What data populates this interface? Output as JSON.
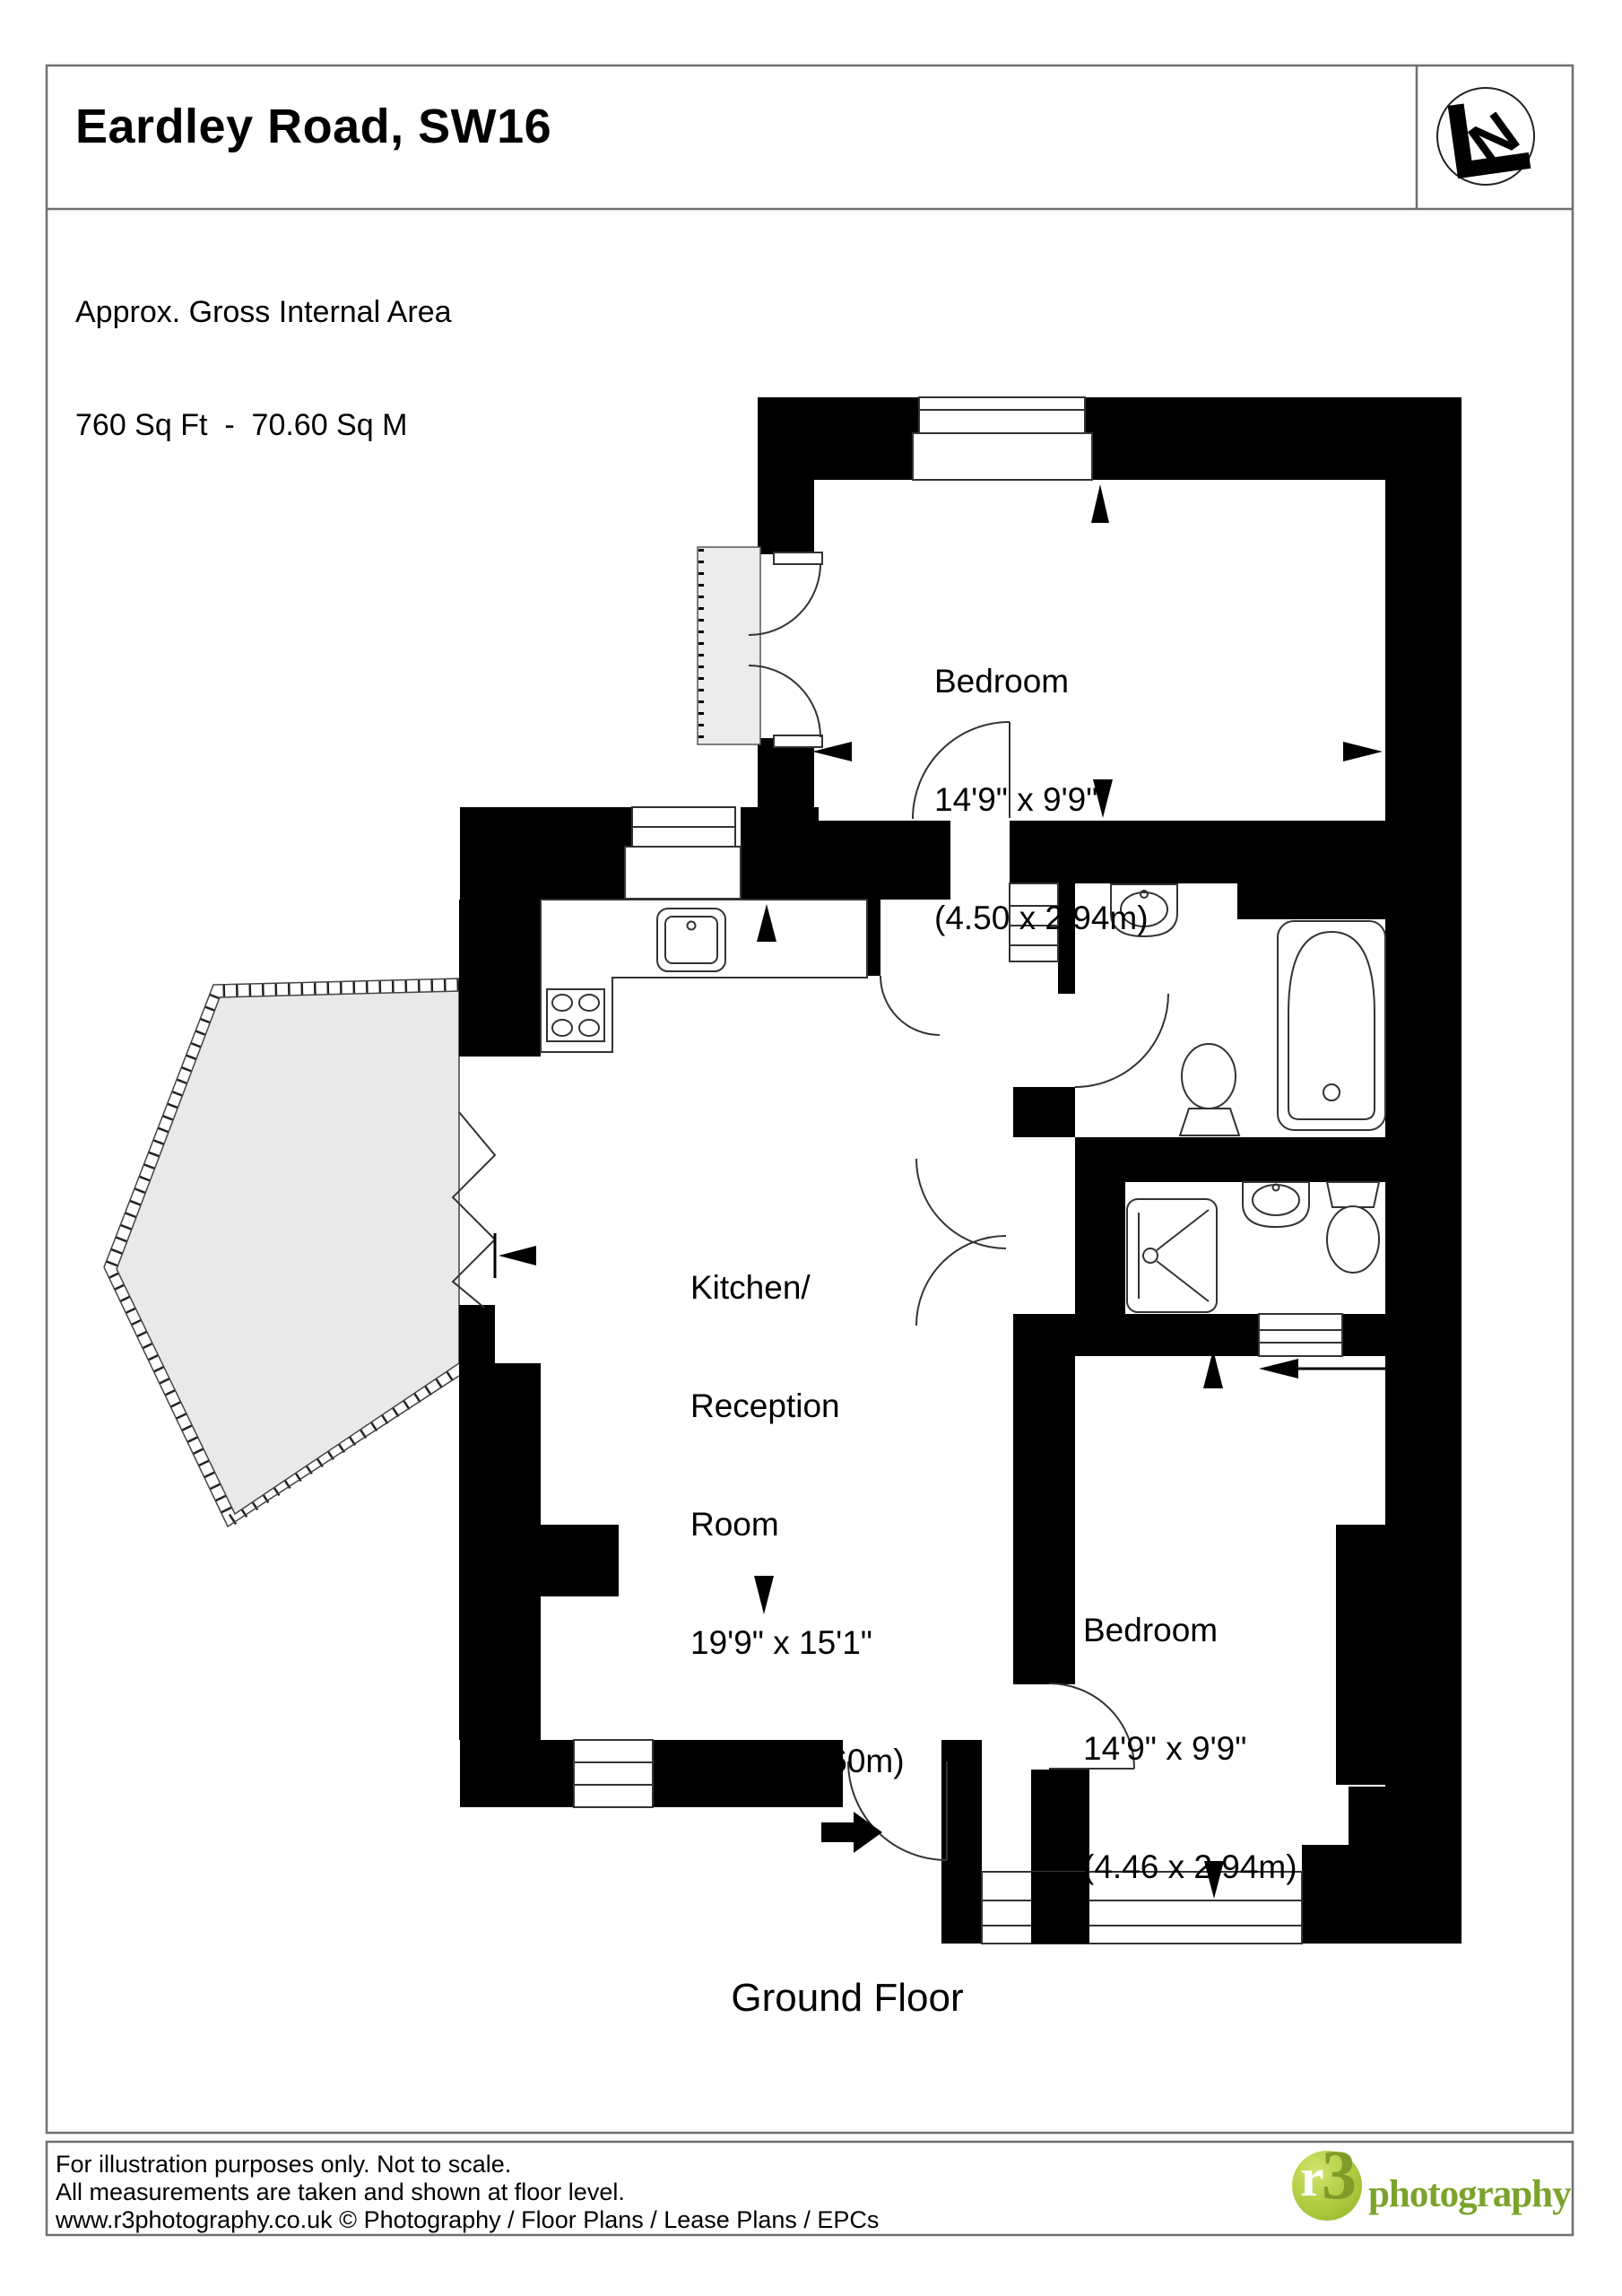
{
  "page": {
    "title": "Eardley Road, SW16",
    "area_line1": "Approx. Gross Internal Area",
    "area_line2": "760 Sq Ft  -  70.60 Sq M",
    "floor_label": "Ground Floor"
  },
  "logo": {
    "compass_letter": "N"
  },
  "rooms": {
    "bedroom_top": {
      "name": "Bedroom",
      "imperial": "14'9\" x 9'9\"",
      "metric": "(4.50 x 2.94m)"
    },
    "kitchen": {
      "line1": "Kitchen/",
      "line2": "Reception",
      "line3": "Room",
      "imperial": "19'9\" x 15'1\"",
      "metric": "(6.05 x 4.60m)"
    },
    "bedroom_bottom": {
      "name": "Bedroom",
      "imperial": "14'9\" x 9'9\"",
      "metric": "(4.46 x 2.94m)"
    }
  },
  "footer": {
    "line1": "For illustration purposes only. Not to scale.",
    "line2": "All measurements are taken and shown at floor level.",
    "line3": "www.r3photography.co.uk © Photography / Floor Plans / Lease Plans / EPCs",
    "logo_r": "r",
    "logo_3": "3",
    "logo_text": "photography"
  },
  "colors": {
    "wall": "#000000",
    "bay_fill": "#e9e9e9",
    "logo_green": "#a8c43c",
    "logo_text_green": "#7ba32b",
    "border_gray": "#6f6f6f"
  }
}
